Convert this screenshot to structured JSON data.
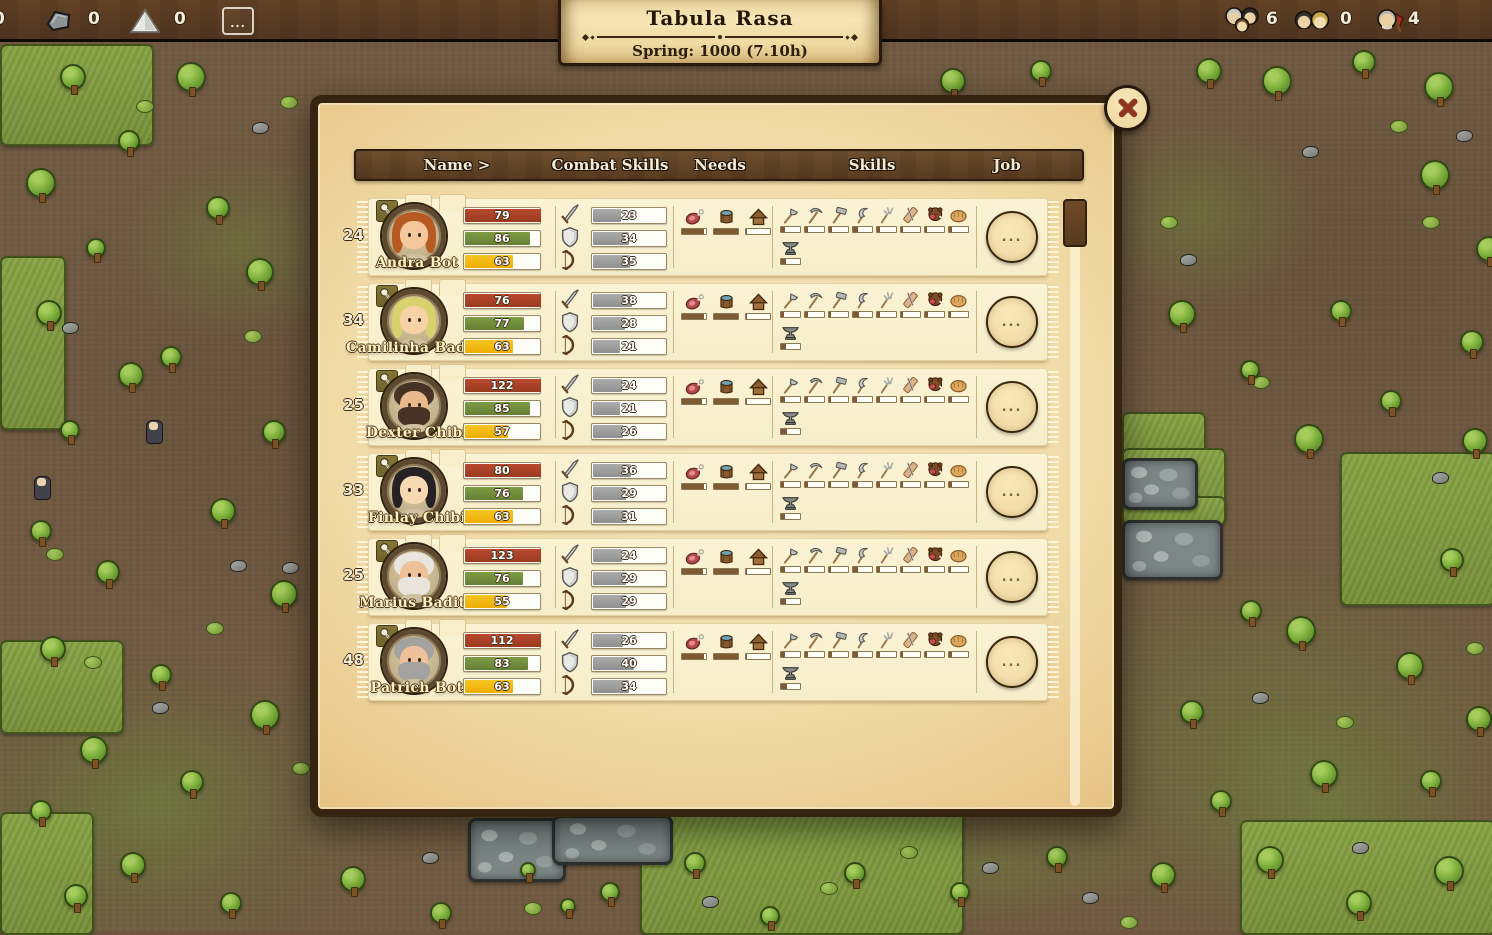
{
  "topbar": {
    "edge_count": "0",
    "resources": [
      {
        "icon": "stone-icon",
        "count": "0"
      },
      {
        "icon": "sand-icon",
        "count": "0"
      }
    ],
    "more_label": "...",
    "population": [
      {
        "icon": "family-icon",
        "count": "6"
      },
      {
        "icon": "adults-icon",
        "count": "0"
      },
      {
        "icon": "worker-icon",
        "count": "4"
      }
    ]
  },
  "banner": {
    "title": "Tabula Rasa",
    "subtitle": "Spring: 1000  (7.10h)"
  },
  "dialog": {
    "columns": [
      "Name >",
      "Combat Skills",
      "Needs",
      "Skills",
      "Job"
    ],
    "job_button_label": "...",
    "rows": [
      {
        "age": "24",
        "name": "Andra Bot",
        "portrait": {
          "hair": "#b65a22",
          "style": "long",
          "beard": null,
          "skin": "#f4c89c"
        },
        "stats": [
          {
            "color": "red",
            "value": 79,
            "fill": 100
          },
          {
            "color": "green",
            "value": 86,
            "fill": 86
          },
          {
            "color": "yellow",
            "value": 63,
            "fill": 63
          }
        ],
        "combat": [
          {
            "icon": "sword",
            "value": 23
          },
          {
            "icon": "shield",
            "value": 34
          },
          {
            "icon": "bow",
            "value": 35
          }
        ],
        "needs": [
          {
            "icon": "food",
            "fill": 92
          },
          {
            "icon": "drink",
            "fill": 100
          },
          {
            "icon": "shelter",
            "fill": 4
          }
        ],
        "skills": [
          {
            "icon": "axe",
            "fill": 22
          },
          {
            "icon": "pickaxe",
            "fill": 16
          },
          {
            "icon": "hammer",
            "fill": 14
          },
          {
            "icon": "sickle",
            "fill": 26
          },
          {
            "icon": "pitchfork",
            "fill": 14
          },
          {
            "icon": "butcher",
            "fill": 10
          },
          {
            "icon": "animal",
            "fill": 12
          },
          {
            "icon": "bread",
            "fill": 14
          },
          {
            "icon": "anvil",
            "fill": 28
          }
        ]
      },
      {
        "age": "34",
        "name": "Camilinha Badita",
        "portrait": {
          "hair": "#d9d06e",
          "style": "long",
          "beard": null,
          "skin": "#f6d2a6"
        },
        "stats": [
          {
            "color": "red",
            "value": 76,
            "fill": 100
          },
          {
            "color": "green",
            "value": 77,
            "fill": 77
          },
          {
            "color": "yellow",
            "value": 63,
            "fill": 63
          }
        ],
        "combat": [
          {
            "icon": "sword",
            "value": 38
          },
          {
            "icon": "shield",
            "value": 28
          },
          {
            "icon": "bow",
            "value": 21
          }
        ],
        "needs": [
          {
            "icon": "food",
            "fill": 90
          },
          {
            "icon": "drink",
            "fill": 100
          },
          {
            "icon": "shelter",
            "fill": 4
          }
        ],
        "skills": [
          {
            "icon": "axe",
            "fill": 18
          },
          {
            "icon": "pickaxe",
            "fill": 14
          },
          {
            "icon": "hammer",
            "fill": 12
          },
          {
            "icon": "sickle",
            "fill": 30
          },
          {
            "icon": "pitchfork",
            "fill": 16
          },
          {
            "icon": "butcher",
            "fill": 10
          },
          {
            "icon": "animal",
            "fill": 14
          },
          {
            "icon": "bread",
            "fill": 12
          },
          {
            "icon": "anvil",
            "fill": 24
          }
        ]
      },
      {
        "age": "25",
        "name": "Dexter Chibi",
        "portrait": {
          "hair": "#473325",
          "style": "short",
          "beard": "#473325",
          "skin": "#e9b98c"
        },
        "stats": [
          {
            "color": "red",
            "value": 122,
            "fill": 100
          },
          {
            "color": "green",
            "value": 85,
            "fill": 85
          },
          {
            "color": "yellow",
            "value": 57,
            "fill": 57
          }
        ],
        "combat": [
          {
            "icon": "sword",
            "value": 24
          },
          {
            "icon": "shield",
            "value": 21
          },
          {
            "icon": "bow",
            "value": 26
          }
        ],
        "needs": [
          {
            "icon": "food",
            "fill": 85
          },
          {
            "icon": "drink",
            "fill": 100
          },
          {
            "icon": "shelter",
            "fill": 4
          }
        ],
        "skills": [
          {
            "icon": "axe",
            "fill": 20
          },
          {
            "icon": "pickaxe",
            "fill": 15
          },
          {
            "icon": "hammer",
            "fill": 13
          },
          {
            "icon": "sickle",
            "fill": 22
          },
          {
            "icon": "pitchfork",
            "fill": 15
          },
          {
            "icon": "butcher",
            "fill": 10
          },
          {
            "icon": "animal",
            "fill": 13
          },
          {
            "icon": "bread",
            "fill": 15
          },
          {
            "icon": "anvil",
            "fill": 30
          }
        ]
      },
      {
        "age": "33",
        "name": "Finlay Chibi",
        "portrait": {
          "hair": "#262223",
          "style": "long",
          "beard": null,
          "skin": "#f6d8b2"
        },
        "stats": [
          {
            "color": "red",
            "value": 80,
            "fill": 100
          },
          {
            "color": "green",
            "value": 76,
            "fill": 76
          },
          {
            "color": "yellow",
            "value": 63,
            "fill": 63
          }
        ],
        "combat": [
          {
            "icon": "sword",
            "value": 36
          },
          {
            "icon": "shield",
            "value": 29
          },
          {
            "icon": "bow",
            "value": 31
          }
        ],
        "needs": [
          {
            "icon": "food",
            "fill": 90
          },
          {
            "icon": "drink",
            "fill": 100
          },
          {
            "icon": "shelter",
            "fill": 4
          }
        ],
        "skills": [
          {
            "icon": "axe",
            "fill": 16
          },
          {
            "icon": "pickaxe",
            "fill": 14
          },
          {
            "icon": "hammer",
            "fill": 12
          },
          {
            "icon": "sickle",
            "fill": 24
          },
          {
            "icon": "pitchfork",
            "fill": 14
          },
          {
            "icon": "butcher",
            "fill": 10
          },
          {
            "icon": "animal",
            "fill": 12
          },
          {
            "icon": "bread",
            "fill": 14
          },
          {
            "icon": "anvil",
            "fill": 22
          }
        ]
      },
      {
        "age": "25",
        "name": "Marius Badita",
        "portrait": {
          "hair": "#e9e5dc",
          "style": "short",
          "beard": "#e9e5dc",
          "skin": "#eec19a"
        },
        "stats": [
          {
            "color": "red",
            "value": 123,
            "fill": 100
          },
          {
            "color": "green",
            "value": 76,
            "fill": 76
          },
          {
            "color": "yellow",
            "value": 55,
            "fill": 55
          }
        ],
        "combat": [
          {
            "icon": "sword",
            "value": 24
          },
          {
            "icon": "shield",
            "value": 29
          },
          {
            "icon": "bow",
            "value": 29
          }
        ],
        "needs": [
          {
            "icon": "food",
            "fill": 88
          },
          {
            "icon": "drink",
            "fill": 100
          },
          {
            "icon": "shelter",
            "fill": 4
          }
        ],
        "skills": [
          {
            "icon": "axe",
            "fill": 20
          },
          {
            "icon": "pickaxe",
            "fill": 16
          },
          {
            "icon": "hammer",
            "fill": 12
          },
          {
            "icon": "sickle",
            "fill": 26
          },
          {
            "icon": "pitchfork",
            "fill": 15
          },
          {
            "icon": "butcher",
            "fill": 10
          },
          {
            "icon": "animal",
            "fill": 14
          },
          {
            "icon": "bread",
            "fill": 13
          },
          {
            "icon": "anvil",
            "fill": 26
          }
        ]
      },
      {
        "age": "48",
        "name": "Patrich Bot",
        "portrait": {
          "hair": "#a3a2a0",
          "style": "short",
          "beard": "#a3a2a0",
          "skin": "#eec19a"
        },
        "stats": [
          {
            "color": "red",
            "value": 112,
            "fill": 100
          },
          {
            "color": "green",
            "value": 83,
            "fill": 83
          },
          {
            "color": "yellow",
            "value": 63,
            "fill": 63
          }
        ],
        "combat": [
          {
            "icon": "sword",
            "value": 26
          },
          {
            "icon": "shield",
            "value": 40
          },
          {
            "icon": "bow",
            "value": 34
          }
        ],
        "needs": [
          {
            "icon": "food",
            "fill": 90
          },
          {
            "icon": "drink",
            "fill": 100
          },
          {
            "icon": "shelter",
            "fill": 4
          }
        ],
        "skills": [
          {
            "icon": "axe",
            "fill": 22
          },
          {
            "icon": "pickaxe",
            "fill": 15
          },
          {
            "icon": "hammer",
            "fill": 14
          },
          {
            "icon": "sickle",
            "fill": 24
          },
          {
            "icon": "pitchfork",
            "fill": 16
          },
          {
            "icon": "butcher",
            "fill": 10
          },
          {
            "icon": "animal",
            "fill": 13
          },
          {
            "icon": "bread",
            "fill": 15
          },
          {
            "icon": "anvil",
            "fill": 30
          }
        ]
      }
    ]
  }
}
